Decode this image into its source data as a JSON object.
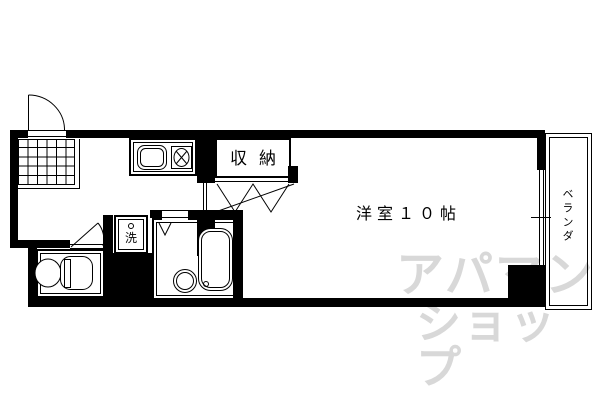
{
  "plan": {
    "rooms": {
      "main_room_label": "洋室１０帖",
      "closet_label": "収納",
      "veranda_label": "ベランダ",
      "washer_label": "洗"
    },
    "watermark": {
      "line1": "アパマン",
      "line2": "ショップ",
      "color": "#d8d8d8"
    },
    "colors": {
      "wall": "#000000",
      "background": "#ffffff"
    }
  }
}
